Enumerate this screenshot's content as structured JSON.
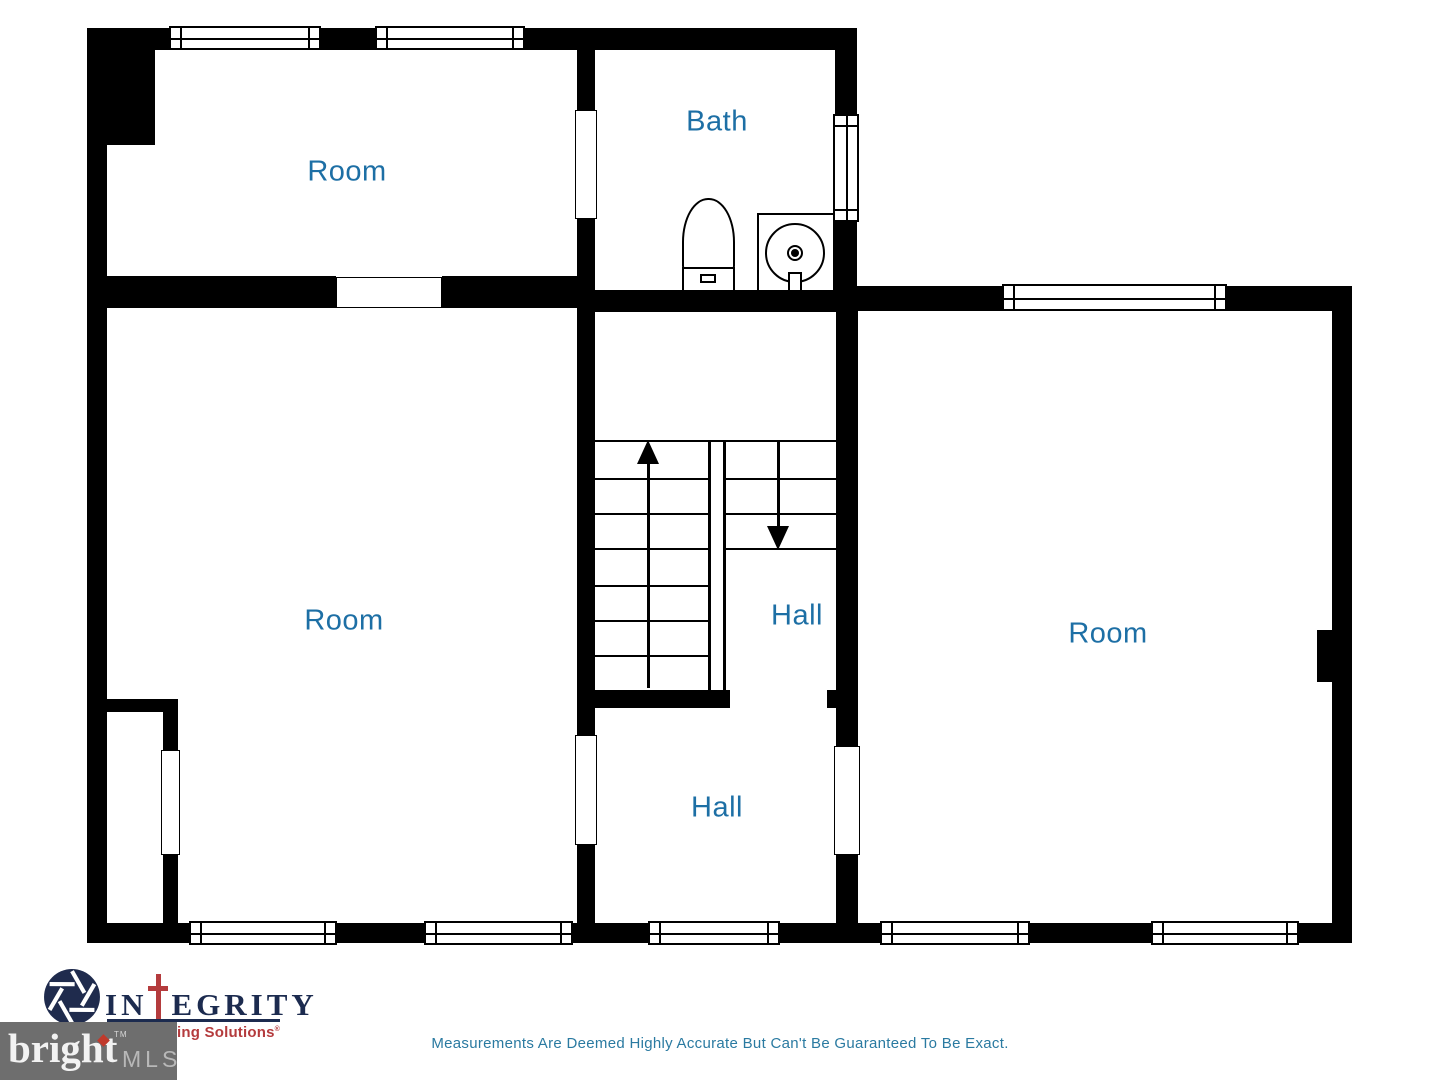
{
  "canvas": {
    "width": 1440,
    "height": 1080,
    "background": "#ffffff"
  },
  "floor_plan": {
    "wall_color": "#000000",
    "label_color": "#1d6fa5",
    "rooms": [
      {
        "id": "room-top-left",
        "label": "Room"
      },
      {
        "id": "bath",
        "label": "Bath"
      },
      {
        "id": "room-middle-left",
        "label": "Room"
      },
      {
        "id": "hall-stairs",
        "label": "Hall"
      },
      {
        "id": "hall-lower",
        "label": "Hall"
      },
      {
        "id": "room-right",
        "label": "Room"
      }
    ],
    "stairs": {
      "left_flight_steps": 7,
      "right_flight_steps": 3,
      "up_arrow": "up",
      "down_arrow": "down"
    },
    "fixtures": [
      "toilet",
      "sink"
    ]
  },
  "footer": {
    "integrity_logo": {
      "word_start": "IN",
      "cross_glyph": "cross",
      "word_end": "EGRITY",
      "tagline": "Imaging Solutions",
      "reg_mark": "®",
      "navy": "#1c2b4f",
      "red": "#b43b3d"
    },
    "bright_mls": {
      "brand": "bright",
      "tm": "TM",
      "suffix": "MLS",
      "box_color": "#6e6e6e"
    },
    "disclaimer": "Measurements Are Deemed Highly Accurate But Can't Be Guaranteed To Be Exact."
  }
}
